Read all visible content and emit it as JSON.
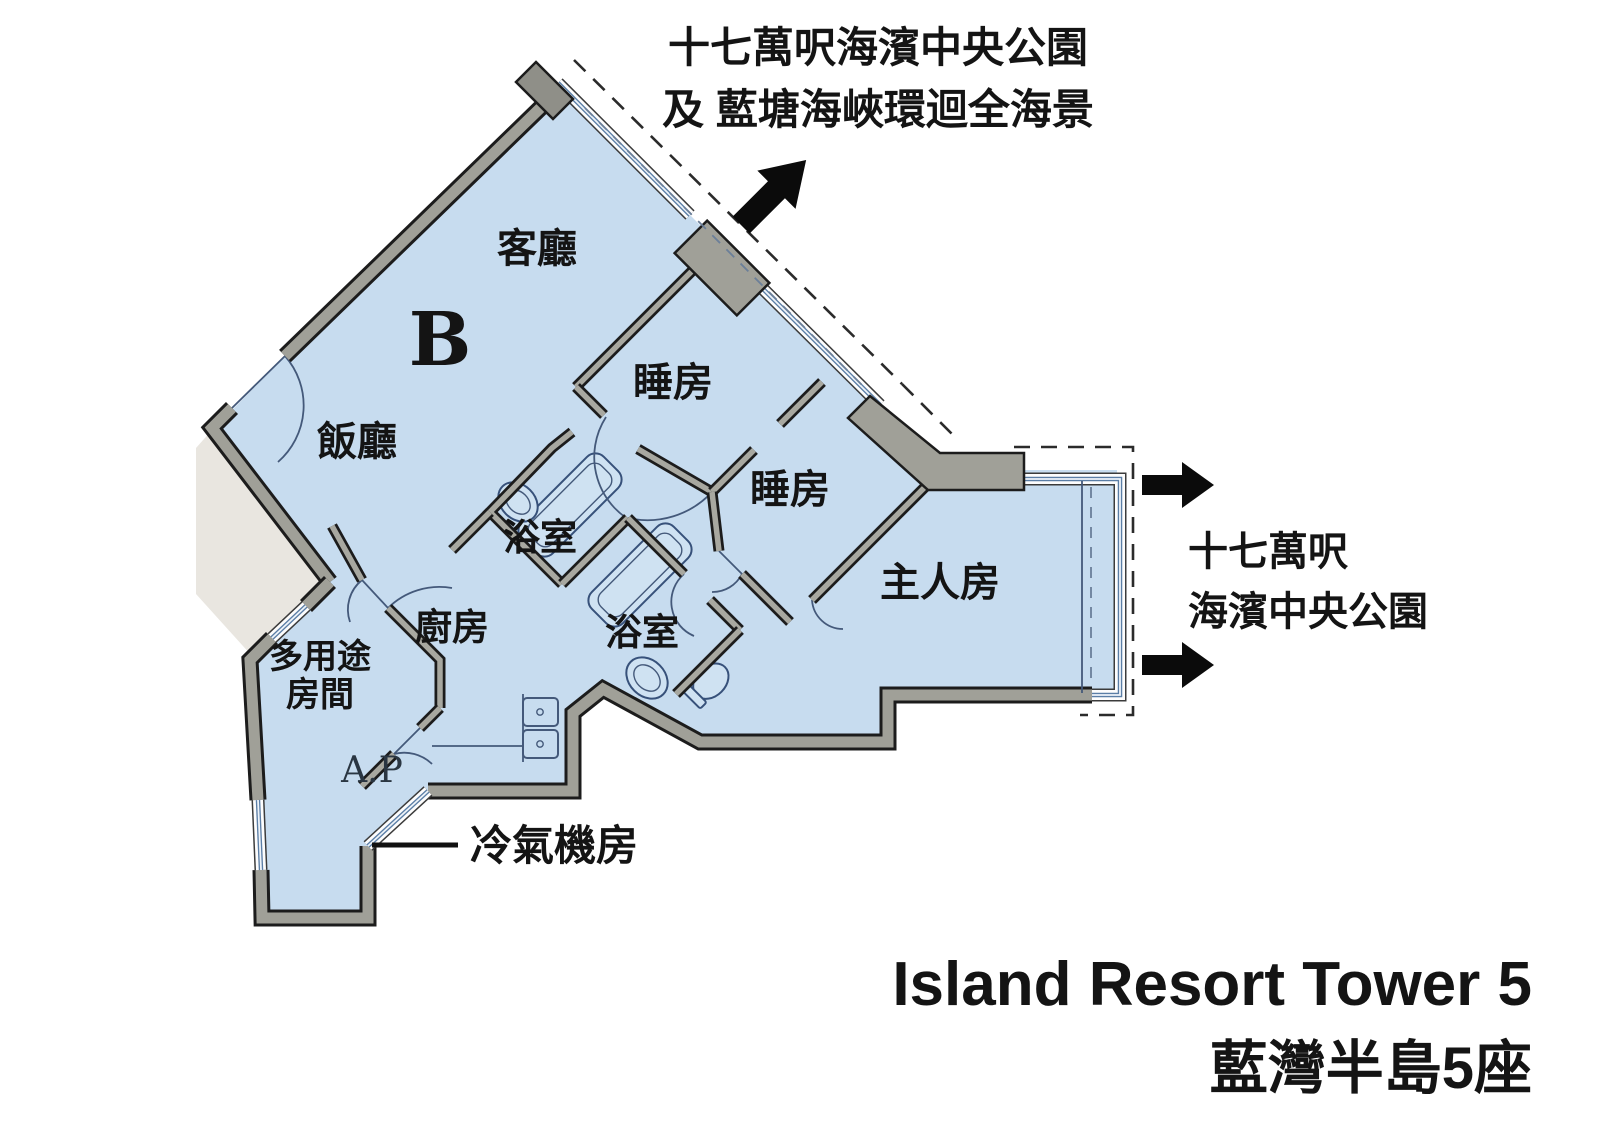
{
  "floor_plan": {
    "unit_label": "B",
    "rooms": {
      "living_room": "客廳",
      "dining_room": "飯廳",
      "bedroom_1": "睡房",
      "bedroom_2": "睡房",
      "master_bedroom": "主人房",
      "bathroom_1": "浴室",
      "bathroom_2": "浴室",
      "kitchen": "廚房",
      "multi_purpose_line1": "多用途",
      "multi_purpose_line2": "房間",
      "ac_platform": "A.P"
    },
    "callouts": {
      "ac_plant_room": "冷氣機房"
    },
    "colors": {
      "room_fill": "#c7dcef",
      "wall_gray": "#a0a098",
      "wall_outline": "#1c1c1c",
      "window_blue": "#5b7ea6",
      "lobby_fill": "#e9e6e0",
      "arrow_black": "#0b0b0b"
    }
  },
  "annotations": {
    "top_view": {
      "line1": "十七萬呎海濱中央公園",
      "line2": "及 藍塘海峽環迴全海景"
    },
    "right_view": {
      "line1": "十七萬呎",
      "line2": "海濱中央公園"
    }
  },
  "title": {
    "line1_en": "Island Resort Tower 5",
    "line2_zh": "藍灣半島5座"
  }
}
